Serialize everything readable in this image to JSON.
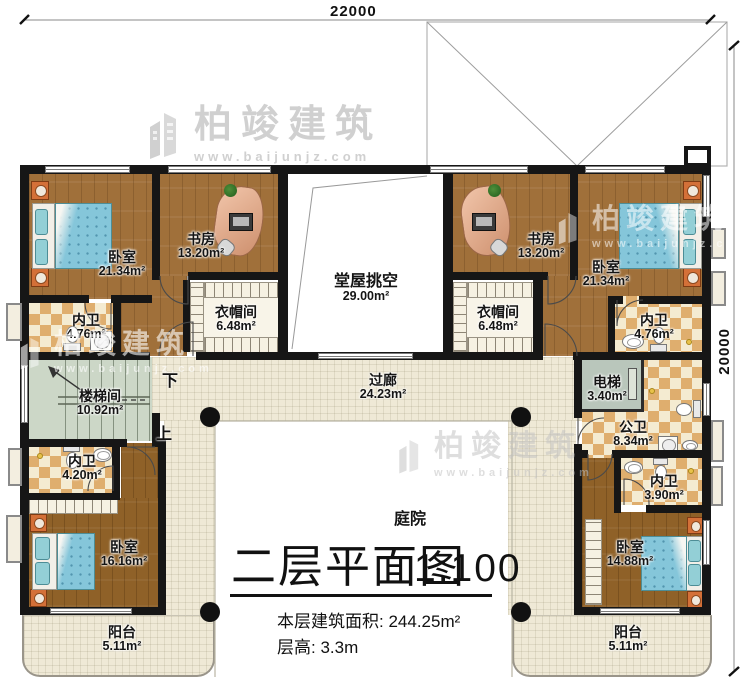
{
  "plan": {
    "drawing_type": "floor-plan",
    "dimensions": {
      "top": "22000",
      "right": "20000"
    },
    "stairs": {
      "down": "下",
      "up": "上"
    },
    "title_block": {
      "title": "二层平面图",
      "scale": "1:100",
      "area_label": "本层建筑面积:",
      "area_value": "244.25m²",
      "height_label": "层高:",
      "height_value": "3.3m"
    },
    "watermark": {
      "brand": "柏竣建筑",
      "url": "www.baijunjz.com"
    }
  },
  "rooms": [
    {
      "name": "卧室",
      "area": "21.34m²"
    },
    {
      "name": "书房",
      "area": "13.20m²"
    },
    {
      "name": "堂屋挑空",
      "area": "29.00m²"
    },
    {
      "name": "书房",
      "area": "13.20m²"
    },
    {
      "name": "卧室",
      "area": "21.34m²"
    },
    {
      "name": "内卫",
      "area": "4.76m²"
    },
    {
      "name": "衣帽间",
      "area": "6.48m²"
    },
    {
      "name": "衣帽间",
      "area": "6.48m²"
    },
    {
      "name": "内卫",
      "area": "4.76m²"
    },
    {
      "name": "楼梯间",
      "area": "10.92m²"
    },
    {
      "name": "过廊",
      "area": "24.23m²"
    },
    {
      "name": "电梯",
      "area": "3.40m²"
    },
    {
      "name": "公卫",
      "area": "8.34m²"
    },
    {
      "name": "内卫",
      "area": "4.20m²"
    },
    {
      "name": "内卫",
      "area": "3.90m²"
    },
    {
      "name": "卧室",
      "area": "16.16m²"
    },
    {
      "name": "卧室",
      "area": "14.88m²"
    },
    {
      "name": "阳台",
      "area": "5.11m²"
    },
    {
      "name": "阳台",
      "area": "5.11m²"
    },
    {
      "name": "庭院",
      "area": ""
    }
  ]
}
